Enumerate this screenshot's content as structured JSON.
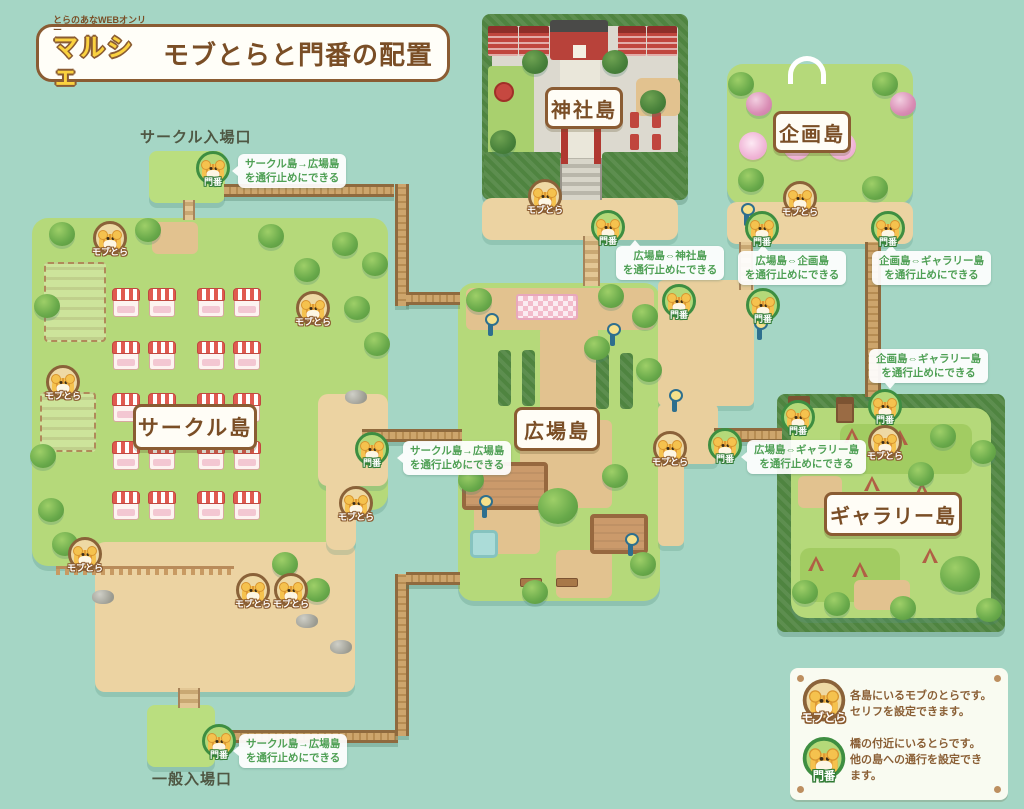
{
  "header": {
    "event_name": "とらのあなWEBオンリー",
    "logo": "マルシェ",
    "title": "モブとらと門番の配置"
  },
  "entrances": {
    "circle": "サークル入場口",
    "general": "一般入場口"
  },
  "islands": {
    "circle": "サークル島",
    "plaza": "広場島",
    "shrine": "神社島",
    "kikaku": "企画島",
    "gallery": "ギャラリー島"
  },
  "characters": {
    "mob": {
      "label": "モブとら",
      "positions": [
        [
          110,
          238
        ],
        [
          313,
          308
        ],
        [
          63,
          382
        ],
        [
          85,
          554
        ],
        [
          253,
          590
        ],
        [
          291,
          590
        ],
        [
          356,
          503
        ],
        [
          545,
          196
        ],
        [
          670,
          448
        ],
        [
          800,
          198
        ],
        [
          885,
          442
        ]
      ]
    },
    "gate": {
      "label": "門番",
      "positions": [
        [
          213,
          168
        ],
        [
          372,
          449
        ],
        [
          219,
          741
        ],
        [
          608,
          227
        ],
        [
          679,
          301
        ],
        [
          762,
          228
        ],
        [
          763,
          305
        ],
        [
          888,
          228
        ],
        [
          885,
          406
        ],
        [
          798,
          417
        ],
        [
          725,
          445
        ]
      ]
    }
  },
  "notes": [
    {
      "x": 238,
      "y": 154,
      "ptr": "left",
      "po": 0,
      "l1": "サークル島→広場島",
      "l2": "を通行止めにできる"
    },
    {
      "x": 403,
      "y": 441,
      "ptr": "left",
      "po": 0,
      "l1": "サークル島→広場島",
      "l2": "を通行止めにできる"
    },
    {
      "x": 239,
      "y": 734,
      "ptr": "left",
      "po": 0,
      "l1": "サークル島→広場島",
      "l2": "を通行止めにできる"
    },
    {
      "x": 616,
      "y": 246,
      "ptr": "up",
      "po": 14,
      "l1": "広場島⇔神社島",
      "l2": "を通行止めにできる"
    },
    {
      "x": 738,
      "y": 251,
      "ptr": "up",
      "po": 20,
      "l1": "広場島⇔企画島",
      "l2": "を通行止めにできる"
    },
    {
      "x": 872,
      "y": 251,
      "ptr": "up",
      "po": 14,
      "l1": "企画島⇔ギャラリー島",
      "l2": "を通行止めにできる"
    },
    {
      "x": 869,
      "y": 349,
      "ptr": "down",
      "po": 16,
      "l1": "企画島⇔ギャラリー島",
      "l2": "を通行止めにできる"
    },
    {
      "x": 747,
      "y": 440,
      "ptr": "left",
      "po": 0,
      "l1": "広場島⇔ギャラリー島",
      "l2": "を通行止めにできる"
    }
  ],
  "legend": {
    "mob_label": "モブとら",
    "mob_text_1": "各島にいるモブのとらです。",
    "mob_text_2": "セリフを設定できます。",
    "gate_label": "門番",
    "gate_text_1": "橋の付近にいるとらです。",
    "gate_text_2": "他の島への通行を設定でき",
    "gate_text_3": "ます。"
  },
  "colors": {
    "background": "#a5d6c5",
    "island_green": "#b5d97a",
    "hedge_green": "#4f8440",
    "sand": "#ecd3a2",
    "bridge": "#c9a267",
    "accent_brown": "#8a5c33",
    "label_text": "#7a4e26",
    "note_green": "#4fa055",
    "mob_ring": "#eed9a4",
    "gate_ring": "#b4d979",
    "booth_red": "#e05a50"
  }
}
